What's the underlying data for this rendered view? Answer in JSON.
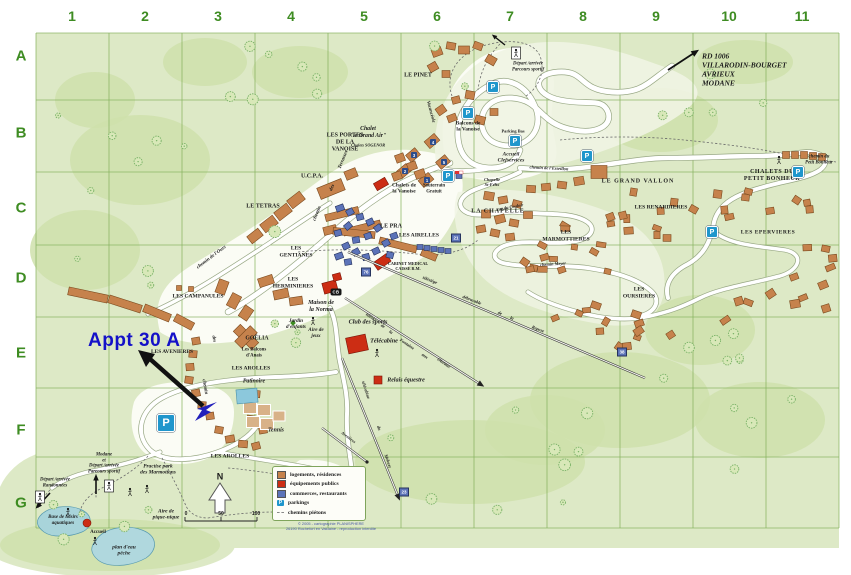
{
  "grid": {
    "columns": [
      "1",
      "2",
      "3",
      "4",
      "5",
      "6",
      "7",
      "8",
      "9",
      "10",
      "11"
    ],
    "rows": [
      "A",
      "B",
      "C",
      "D",
      "E",
      "F",
      "G"
    ]
  },
  "annotation": {
    "label": "Appt 30 A"
  },
  "compass": {
    "label": "N"
  },
  "scale": {
    "ticks": [
      "0",
      "50",
      "100"
    ]
  },
  "legend": {
    "items": [
      {
        "kind": "residences",
        "label": "logements, résidences"
      },
      {
        "kind": "public",
        "label": "équipements publics"
      },
      {
        "kind": "commerces",
        "label": "commerces, restaurants"
      },
      {
        "kind": "parking",
        "label": "parkings"
      },
      {
        "kind": "path",
        "label": "chemins piétons"
      }
    ],
    "credit_line1": "© 2005 - cartographie PLANISPHERE",
    "credit_line2": "26190 Rochefort en Valdaine - reproduction interdite"
  },
  "colors": {
    "residences": "#c6824c",
    "public": "#cc2d14",
    "commerces": "#5c73b8",
    "parking": "#1f96cc",
    "map_green": "#dde9c6",
    "forest_green": "#cfe0ab",
    "grid_green": "#86b25e",
    "label_green": "#3e8c22",
    "annotation_blue": "#1411c8"
  },
  "labels": [
    {
      "t": "LE PINET",
      "x": 418,
      "y": 76,
      "s": 6
    },
    {
      "t": "LES PORTES\nDE LA\nVANOISE",
      "x": 345,
      "y": 143,
      "s": 6
    },
    {
      "t": "U.C.P.A.",
      "x": 312,
      "y": 177,
      "s": 6
    },
    {
      "t": "LE TETRAS",
      "x": 263,
      "y": 207,
      "s": 6
    },
    {
      "t": "LES\nGENTIANES",
      "x": 296,
      "y": 252,
      "s": 5.6
    },
    {
      "t": "LES\nHERMINIERES",
      "x": 293,
      "y": 283,
      "s": 5.6
    },
    {
      "t": "LES CAMPANULES",
      "x": 198,
      "y": 297,
      "s": 5.6
    },
    {
      "t": "LES AROLLES",
      "x": 251,
      "y": 369,
      "s": 5.6
    },
    {
      "t": "LES AROLLES",
      "x": 230,
      "y": 457,
      "s": 5.6
    },
    {
      "t": "LES AVENIERES",
      "x": 172,
      "y": 352,
      "s": 5.4
    },
    {
      "t": "LE GRAND VALLON",
      "x": 638,
      "y": 182,
      "s": 6,
      "ls": 1
    },
    {
      "t": "CHALETS DU\nPETIT BONHEUR",
      "x": 772,
      "y": 176,
      "s": 6,
      "ls": 0.5
    },
    {
      "t": "LES RENARDIERES",
      "x": 661,
      "y": 208,
      "s": 5.6
    },
    {
      "t": "LES EPERVIERES",
      "x": 768,
      "y": 233,
      "s": 5.6,
      "ls": 0.5
    },
    {
      "t": "LES\nMARMOTTIERES",
      "x": 566,
      "y": 236,
      "s": 5.6
    },
    {
      "t": "LES\nOURSIERES",
      "x": 639,
      "y": 293,
      "s": 5.6
    },
    {
      "t": "LA CHAPELLE",
      "x": 498,
      "y": 212,
      "s": 6,
      "ls": 1
    },
    {
      "t": "LE PRA",
      "x": 391,
      "y": 227,
      "s": 6
    },
    {
      "t": "LES AIRELLES",
      "x": 419,
      "y": 236,
      "s": 5.6
    },
    {
      "t": "Chalet\n\"le Grand Air\"",
      "x": 368,
      "y": 133,
      "s": 5.8,
      "i": 1
    },
    {
      "t": "Chalets SOGENOR",
      "x": 368,
      "y": 146,
      "s": 4.2,
      "i": 1
    },
    {
      "t": "Chalets de\nla Vanoise",
      "x": 404,
      "y": 189,
      "s": 5.4
    },
    {
      "t": "Balcons de\nla Vanoise",
      "x": 468,
      "y": 127,
      "s": 5.4
    },
    {
      "t": "Souterrain\nGratuit",
      "x": 434,
      "y": 189,
      "s": 4.8
    },
    {
      "t": "Chapelle\nSt-Félix",
      "x": 492,
      "y": 182,
      "s": 4.4,
      "i": 1
    },
    {
      "t": "Accueil\nClefservices",
      "x": 511,
      "y": 158,
      "s": 5.4,
      "i": 1
    },
    {
      "t": "Parking Bas",
      "x": 513,
      "y": 131,
      "s": 4.4
    },
    {
      "t": "Maison de\nla Norma",
      "x": 321,
      "y": 307,
      "s": 6,
      "i": 1
    },
    {
      "t": "Club des sports",
      "x": 368,
      "y": 322,
      "s": 6.2,
      "i": 1
    },
    {
      "t": "Télécabine",
      "x": 384,
      "y": 341,
      "s": 6.2,
      "i": 1
    },
    {
      "t": "Relais équestre",
      "x": 406,
      "y": 381,
      "s": 6,
      "i": 1
    },
    {
      "t": "Patinoire",
      "x": 254,
      "y": 382,
      "s": 5.8,
      "i": 1
    },
    {
      "t": "Tennis",
      "x": 276,
      "y": 431,
      "s": 5.8,
      "i": 1
    },
    {
      "t": "Jardin\nd'enfants",
      "x": 296,
      "y": 324,
      "s": 5.2,
      "i": 1
    },
    {
      "t": "Aire de\njeux",
      "x": 316,
      "y": 333,
      "s": 5.2,
      "i": 1
    },
    {
      "t": "CABINET MEDICAL\nCAISSE R.M.",
      "x": 408,
      "y": 267,
      "s": 4.2
    },
    {
      "t": "GOËLIA",
      "x": 257,
      "y": 339,
      "s": 5.8
    },
    {
      "t": "Les Balcons\nd'Anais",
      "x": 254,
      "y": 353,
      "s": 4.8
    },
    {
      "t": "Practise park\ndes Marmottons",
      "x": 158,
      "y": 470,
      "s": 5.4,
      "i": 1
    },
    {
      "t": "Base de loisirs\naquatiques",
      "x": 63,
      "y": 521,
      "s": 5,
      "i": 1
    },
    {
      "t": "Accueil",
      "x": 98,
      "y": 533,
      "s": 5
    },
    {
      "t": "plan d'eau\npêche",
      "x": 124,
      "y": 551,
      "s": 5.4,
      "i": 1
    },
    {
      "t": "Aire de\npique-nique",
      "x": 166,
      "y": 515,
      "s": 5.4,
      "i": 1
    },
    {
      "t": "Modane\net\nDépart /arrivée\nParcours sportif",
      "x": 104,
      "y": 464,
      "s": 4.8,
      "i": 1
    },
    {
      "t": "Départ /arrivée\nRandonnées",
      "x": 55,
      "y": 483,
      "s": 4.8,
      "i": 1
    },
    {
      "t": "Départ /arrivée\nParcours sportif",
      "x": 528,
      "y": 67,
      "s": 4.8,
      "i": 1
    },
    {
      "t": "RD 1006\nVILLARODIN-BOURGET\nAVRIEUX\nMODANE",
      "x": 702,
      "y": 70,
      "s": 7.5,
      "i": 1,
      "a": "l"
    },
    {
      "t": "chemin du\nPetit Bonheur",
      "x": 819,
      "y": 160,
      "s": 4.8,
      "i": 1
    },
    {
      "t": "chemin de l'Esseillon",
      "x": 549,
      "y": 168,
      "s": 4.4,
      "i": 1,
      "r": 3
    },
    {
      "t": "rue du Couloir",
      "x": 510,
      "y": 207,
      "s": 4.4,
      "i": 1,
      "r": -10
    },
    {
      "t": "chemin Meyer",
      "x": 553,
      "y": 264,
      "s": 4.4,
      "i": 1,
      "r": -4
    },
    {
      "t": "chemin de l'Ours",
      "x": 212,
      "y": 258,
      "s": 5,
      "i": 1,
      "r": -37
    },
    {
      "t": "chemin",
      "x": 318,
      "y": 214,
      "s": 5,
      "i": 1,
      "r": -68
    },
    {
      "t": "des",
      "x": 333,
      "y": 188,
      "s": 5,
      "i": 1,
      "r": -68
    },
    {
      "t": "Terrasses",
      "x": 344,
      "y": 160,
      "s": 5,
      "i": 1,
      "r": -68
    },
    {
      "t": "chemin",
      "x": 204,
      "y": 387,
      "s": 5,
      "i": 1,
      "r": 80
    },
    {
      "t": "des",
      "x": 213,
      "y": 339,
      "s": 5,
      "i": 1,
      "r": 80
    },
    {
      "t": "télésiège",
      "x": 430,
      "y": 280,
      "s": 4.4,
      "i": 1,
      "r": 21
    },
    {
      "t": "débrayable",
      "x": 472,
      "y": 300,
      "s": 4.4,
      "i": 1,
      "r": 21
    },
    {
      "t": "de",
      "x": 500,
      "y": 313,
      "s": 4.4,
      "i": 1,
      "r": 21
    },
    {
      "t": "la",
      "x": 512,
      "y": 318,
      "s": 4.4,
      "i": 1,
      "r": 21
    },
    {
      "t": "Repose",
      "x": 538,
      "y": 329,
      "s": 4.4,
      "i": 1,
      "r": 21
    },
    {
      "t": "téléski",
      "x": 371,
      "y": 317,
      "s": 4.4,
      "i": 1,
      "r": 34
    },
    {
      "t": "de",
      "x": 383,
      "y": 326,
      "s": 4.4,
      "i": 1,
      "r": 34
    },
    {
      "t": "la",
      "x": 391,
      "y": 332,
      "s": 4.4,
      "i": 1,
      "r": 34
    },
    {
      "t": "Fontaine",
      "x": 407,
      "y": 344,
      "s": 4.4,
      "i": 1,
      "r": 34
    },
    {
      "t": "aux",
      "x": 425,
      "y": 356,
      "s": 4.4,
      "i": 1,
      "r": 34
    },
    {
      "t": "Oiseaux",
      "x": 444,
      "y": 363,
      "s": 4.4,
      "i": 1,
      "r": 34
    },
    {
      "t": "télécabine",
      "x": 366,
      "y": 390,
      "s": 4.4,
      "i": 1,
      "r": 72
    },
    {
      "t": "du",
      "x": 379,
      "y": 428,
      "s": 4.4,
      "i": 1,
      "r": 72
    },
    {
      "t": "Mélezet",
      "x": 388,
      "y": 461,
      "s": 4.4,
      "i": 1,
      "r": 72
    },
    {
      "t": "Avenières",
      "x": 348,
      "y": 438,
      "s": 4.2,
      "i": 1,
      "r": 37
    },
    {
      "t": "Vacancéole",
      "x": 430,
      "y": 112,
      "s": 4.8,
      "i": 1,
      "r": 75
    },
    {
      "t": "N",
      "x": 220,
      "y": 477,
      "s": 9,
      "f": "sans"
    },
    {
      "t": "0",
      "x": 186,
      "y": 515,
      "s": 5,
      "f": "sans"
    },
    {
      "t": "50",
      "x": 221,
      "y": 515,
      "s": 5,
      "f": "sans"
    },
    {
      "t": "100",
      "x": 256,
      "y": 515,
      "s": 5,
      "f": "sans"
    }
  ],
  "parkings": [
    {
      "x": 493,
      "y": 87
    },
    {
      "x": 468,
      "y": 113
    },
    {
      "x": 515,
      "y": 141
    },
    {
      "x": 448,
      "y": 176
    },
    {
      "x": 587,
      "y": 156
    },
    {
      "x": 798,
      "y": 172
    },
    {
      "x": 712,
      "y": 232
    },
    {
      "x": 166,
      "y": 423,
      "big": true
    }
  ],
  "markers": [
    {
      "t": "CB",
      "x": 336,
      "y": 292,
      "k": "cb"
    },
    {
      "t": "1",
      "x": 427,
      "y": 180,
      "k": "chip"
    },
    {
      "t": "2",
      "x": 405,
      "y": 171,
      "k": "chip"
    },
    {
      "t": "3",
      "x": 414,
      "y": 155,
      "k": "chip"
    },
    {
      "t": "4",
      "x": 433,
      "y": 142,
      "k": "chip"
    },
    {
      "t": "5",
      "x": 444,
      "y": 162,
      "k": "chip"
    },
    {
      "t": "21",
      "x": 456,
      "y": 238,
      "k": "blue"
    },
    {
      "t": "76",
      "x": 366,
      "y": 272,
      "k": "blue"
    },
    {
      "t": "23",
      "x": 404,
      "y": 492,
      "k": "blue"
    },
    {
      "t": "38",
      "x": 622,
      "y": 352,
      "k": "blue"
    }
  ]
}
